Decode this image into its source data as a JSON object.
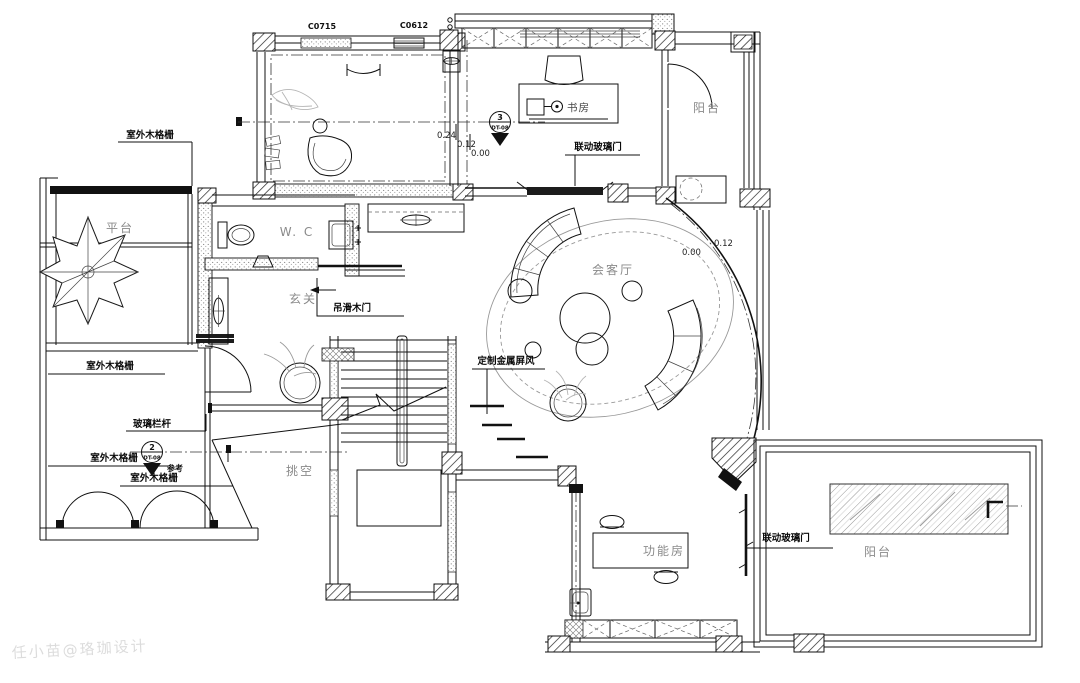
{
  "plan": {
    "watermark": "任小苗@珞珈设计",
    "windows": {
      "w1": "C0715",
      "w2": "C0612"
    },
    "rooms": {
      "study": "书房",
      "study_desk": "书房",
      "balcony_top": "阳台",
      "reception": "会客厅",
      "wc": "W. C",
      "foyer": "玄关",
      "void_space": "挑空",
      "function_room": "功能房",
      "balcony_bottom": "阳台",
      "platform": "平台"
    },
    "labels": {
      "grille1": "室外木格栅",
      "grille2": "室外木格栅",
      "grille3": "室外木格栅",
      "grille4": "室外木格栅",
      "glass_rail": "玻璃栏杆",
      "sliding_wood_door": "吊滑木门",
      "linked_glass_door_top": "联动玻璃门",
      "linked_glass_door_bottom": "联动玻璃门",
      "metal_screen": "定制金属屏风",
      "reference": "参考"
    },
    "levels": {
      "study_step_high": "0.24",
      "study_step_mid": "0.12",
      "study_step_low": "0.00",
      "reception_low": "0.00",
      "reception_high": "0.12"
    },
    "markers": {
      "m3": {
        "num": "3",
        "code": "DT-08"
      },
      "m2": {
        "num": "2",
        "code": "DT-08"
      }
    }
  }
}
